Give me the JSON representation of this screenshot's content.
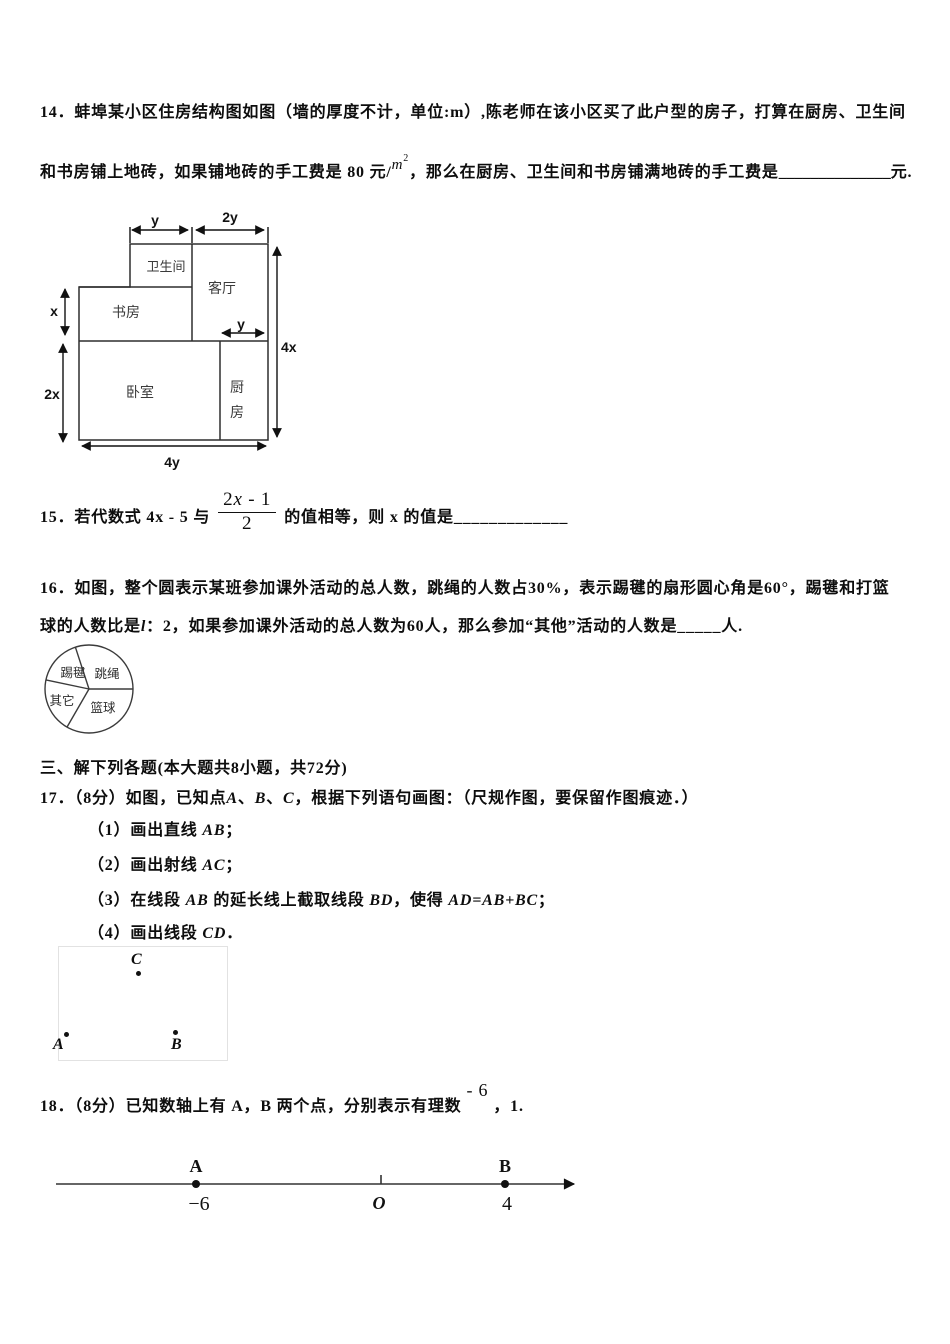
{
  "q14": {
    "line1": "14．蚌埠某小区住房结构图如图（墙的厚度不计，单位:m）,陈老师在该小区买了此户型的房子，打算在厨房、卫生间",
    "line2_parts": [
      {
        "t": "和书房铺上地砖，如果铺地砖的手工费是 80 元/"
      },
      {
        "t": "m",
        "c": "msup"
      },
      {
        "t": "2",
        "c": "msup2"
      },
      {
        "t": "，那么在厨房、卫生间和书房铺满地砖的手工费是"
      },
      {
        "t": "______________",
        "c": "blank"
      },
      {
        "t": "元."
      }
    ],
    "diagram": {
      "rooms": {
        "bathroom": "卫生间",
        "living": "客厅",
        "study": "书房",
        "bedroom": "卧室",
        "kitchen_1": "厨",
        "kitchen_2": "房"
      },
      "dims": {
        "top_left": "y",
        "top_right": "2y",
        "left_upper": "x",
        "left_lower": "2x",
        "right": "4x",
        "bottom": "4y",
        "kitchen_top": "y"
      }
    }
  },
  "q15": {
    "prefix": "15．若代数式 4x - 5 与",
    "frac_num_parts": [
      {
        "t": "2"
      },
      {
        "t": "x",
        "c": "it"
      },
      {
        "t": " - 1"
      }
    ],
    "frac_den": "2",
    "suffix": "的值相等，则 x 的值是_____________"
  },
  "q16": {
    "line1": "16．如图，整个圆表示某班参加课外活动的总人数，跳绳的人数占30%，表示踢毽的扇形圆心角是60°，踢毽和打篮",
    "line2_parts": [
      {
        "t": "球的人数比是"
      },
      {
        "t": "l",
        "c": "it"
      },
      {
        "t": "：2，如果参加课外活动的总人数为60人，那么参加“其他”活动的人数是_____人."
      }
    ],
    "pie": {
      "type": "pie",
      "sectors": [
        {
          "label": "跳绳",
          "angle_deg": 108
        },
        {
          "label": "踢毽",
          "angle_deg": 60
        },
        {
          "label": "其它",
          "angle_deg": 72
        },
        {
          "label": "篮球",
          "angle_deg": 120
        }
      ]
    }
  },
  "section3": {
    "header": "三、解下列各题(本大题共8小题，共72分)"
  },
  "q17": {
    "title_parts": [
      {
        "t": "17．（8分）如图，已知点"
      },
      {
        "t": "A",
        "c": "it"
      },
      {
        "t": "、"
      },
      {
        "t": "B",
        "c": "it"
      },
      {
        "t": "、"
      },
      {
        "t": "C",
        "c": "it"
      },
      {
        "t": "，根据下列语句画图：（尺规作图，要保留作图痕迹．）"
      }
    ],
    "item1_parts": [
      {
        "t": "（1）画出直线"
      },
      {
        "t": " AB",
        "c": "it"
      },
      {
        "t": "；"
      }
    ],
    "item2_parts": [
      {
        "t": "（2）画出射线"
      },
      {
        "t": " AC",
        "c": "it"
      },
      {
        "t": "；"
      }
    ],
    "item3_parts": [
      {
        "t": "（3）在线段"
      },
      {
        "t": " AB ",
        "c": "it"
      },
      {
        "t": "的延长线上截取线段"
      },
      {
        "t": " BD",
        "c": "it"
      },
      {
        "t": "，使得"
      },
      {
        "t": " AD=AB+BC",
        "c": "it"
      },
      {
        "t": "；"
      }
    ],
    "item4_parts": [
      {
        "t": "（4）画出线段"
      },
      {
        "t": " CD",
        "c": "it"
      },
      {
        "t": "．"
      }
    ],
    "figure_points": {
      "a": "A",
      "b": "B",
      "c": "C"
    }
  },
  "q18": {
    "line_parts": [
      {
        "t": "18．（8分）已知数轴上有 A，B 两个点，分别表示有理数"
      },
      {
        "t": "- 6",
        "c": "raised"
      },
      {
        "t": "，1."
      }
    ],
    "numberline": {
      "label_a": "A",
      "value_a": "−6",
      "origin": "O",
      "label_b": "B",
      "value_b": "4"
    }
  }
}
